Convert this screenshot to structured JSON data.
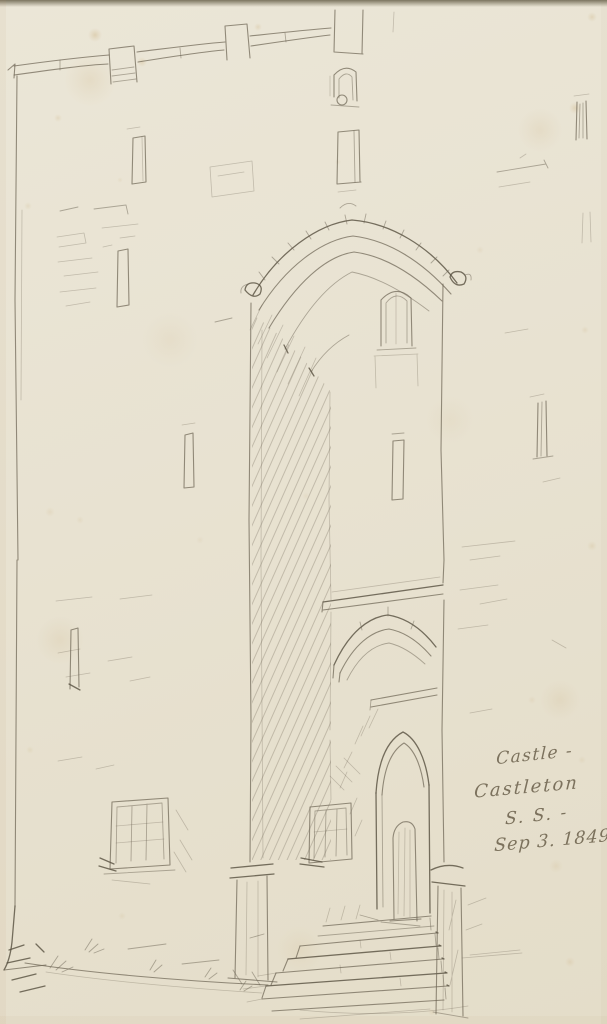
{
  "artwork": {
    "inscription": {
      "line1": "Castle -",
      "line2": "Castleton",
      "line3": "S. S. -",
      "line4": "Sep 3. 1849"
    },
    "colors": {
      "paper": "#e9e3d2",
      "pencil": "#6e6555",
      "ink": "#564f3e",
      "stain": "#b9924e"
    }
  }
}
